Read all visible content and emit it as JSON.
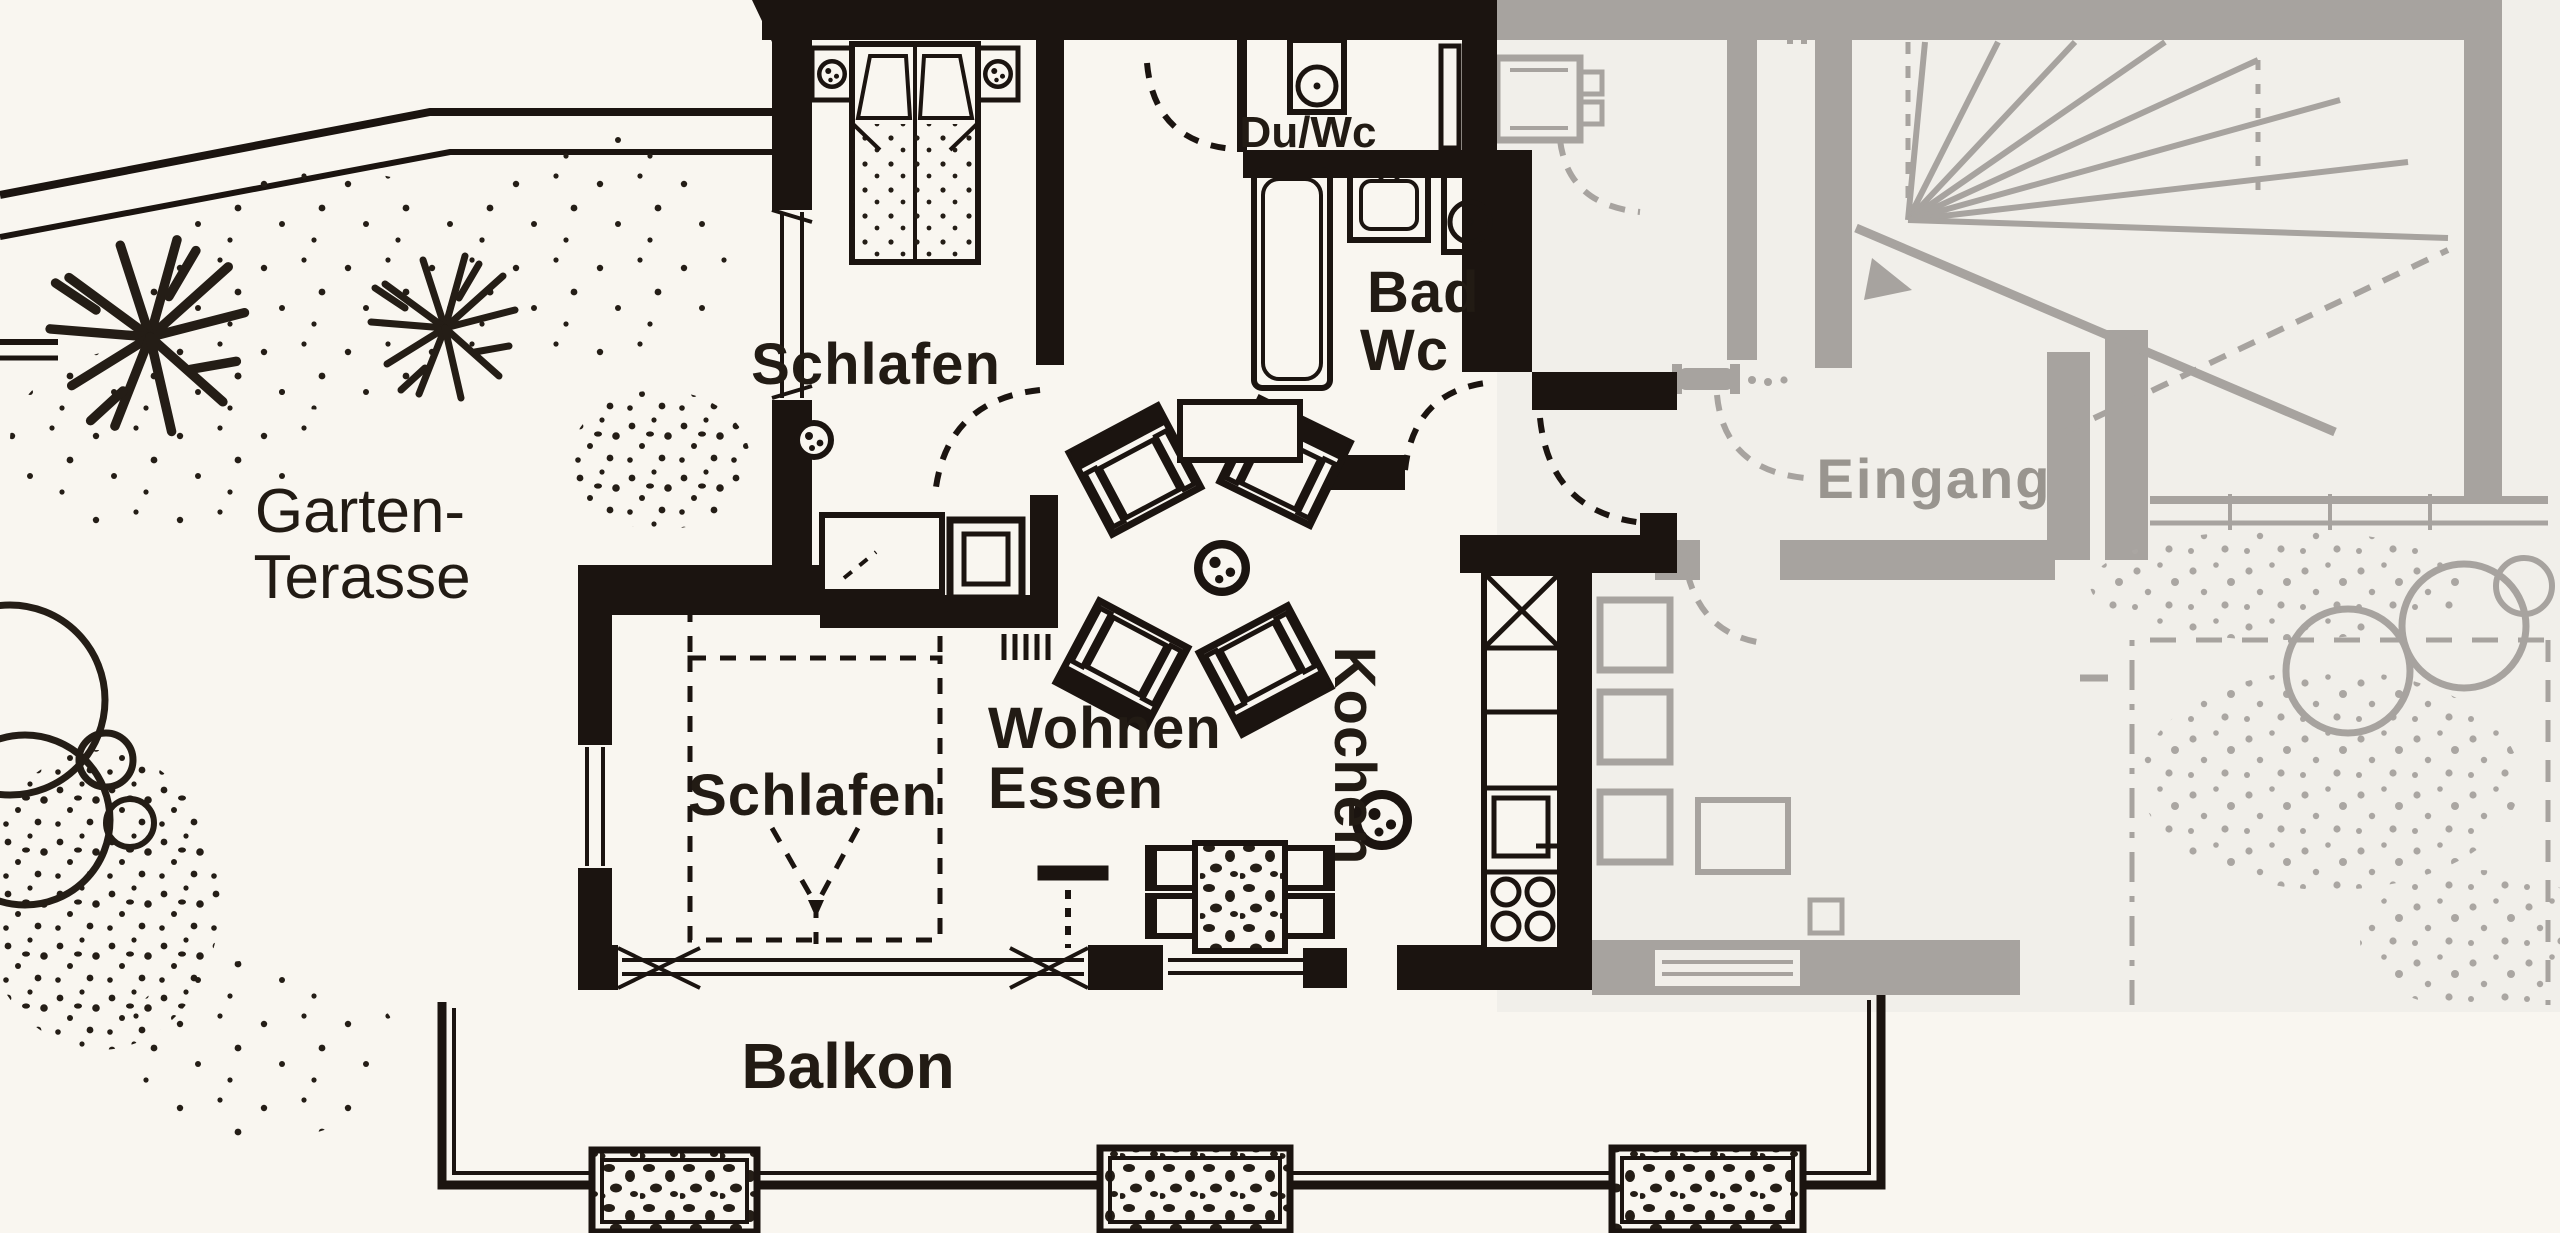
{
  "labels": {
    "garten": {
      "line1": "Garten-",
      "line2": "Terasse"
    },
    "schlafen_top": "Schlafen",
    "du_wc": "Du/Wc",
    "bad": {
      "line1": "Bad",
      "line2": "Wc"
    },
    "wohnen": {
      "line1": "Wohnen",
      "line2": "Essen"
    },
    "kochen": "Kochen",
    "schlafen_bottom": "Schlafen",
    "eingang": "Eingang",
    "balkon": "Balkon"
  },
  "colors": {
    "paper": "#f9f6f0",
    "paper_gray": "#f1efea",
    "ink": "#1b1410",
    "gray": "#a7a39f"
  }
}
